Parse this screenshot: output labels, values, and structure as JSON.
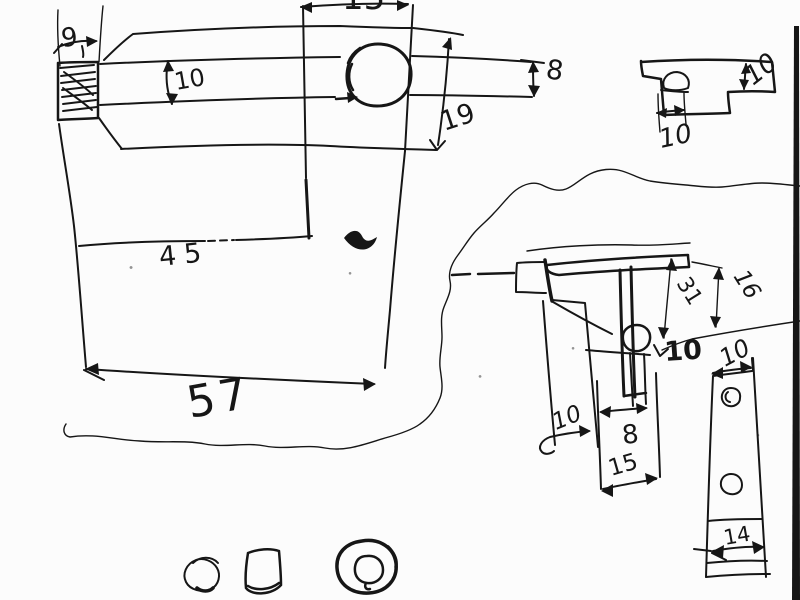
{
  "colors": {
    "ink": "#161616",
    "paper": "#fcfcfc",
    "scan_border": "#0c0c0c"
  },
  "labels": {
    "knob_width": "9",
    "collar_width_partial": "15",
    "shaft_height": "10",
    "tip_height": "8",
    "head_depth": "19",
    "tee_height": "10",
    "tee_slot_width": "10",
    "body_mid_width": "45",
    "body_total_width": "57",
    "bracket_depth": "31",
    "bracket_upper_height": "16",
    "hole_offset_bold": "10",
    "arm_width": "10",
    "pin_width": "8",
    "leg_width": "15",
    "strip_width": "10",
    "strip_section_width": "14"
  }
}
